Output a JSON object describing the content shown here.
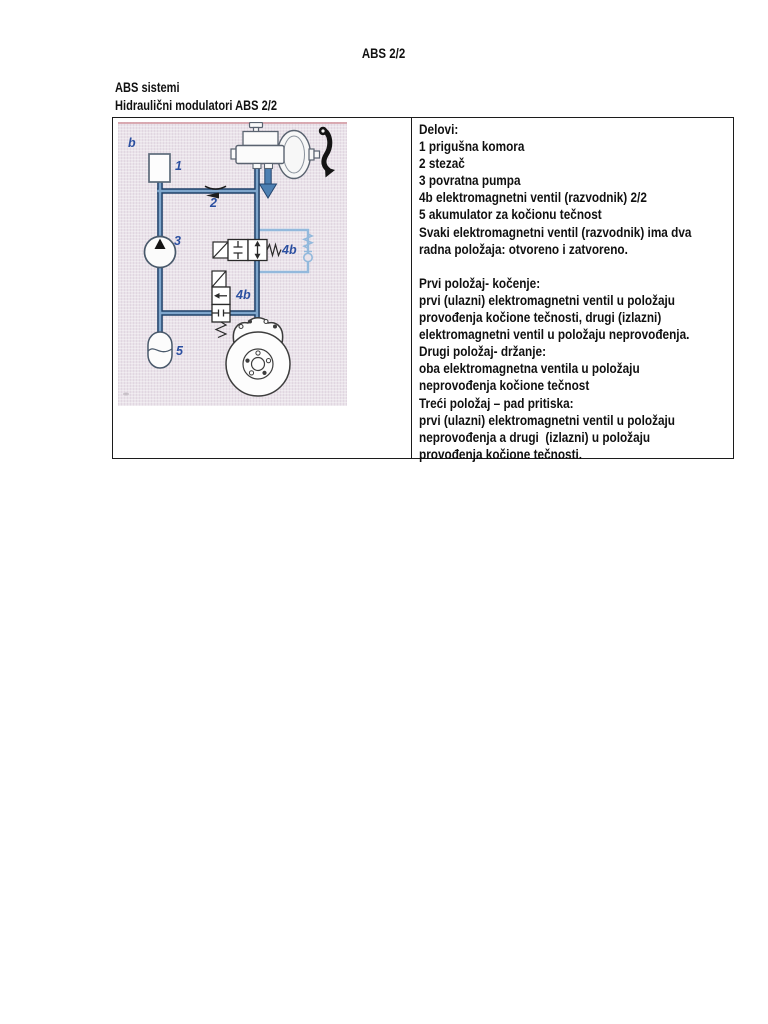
{
  "page_title": "ABS 2/2",
  "headings": {
    "line1": "ABS sistemi",
    "line2": "Hidraulični modulatori ABS 2/2"
  },
  "diagram": {
    "labels": {
      "b": "b",
      "n1": "1",
      "n2": "2",
      "n3": "3",
      "v4b_upper": "4b",
      "v4b_lower": "4b",
      "n5": "5"
    },
    "colors": {
      "scan_background": "#eae3ea",
      "scan_edge_pink": "#d49aa2",
      "pipe_dark": "#1f4068",
      "pipe_light": "#7fa6cc",
      "bypass_blue": "#93b9dc",
      "label_blue": "#2b4fa0"
    }
  },
  "info_panel": {
    "lines": [
      "Delovi:",
      "1 prigušna komora",
      "2 stezač",
      "3 povratna pumpa",
      "4b elektromagnetni ventil (razvodnik) 2/2",
      "5 akumulator za kočionu tečnost",
      "Svaki elektromagnetni ventil (razvodnik) ima dva",
      "radna položaja: otvoreno i zatvoreno.",
      "",
      "Prvi položaj- kočenje:",
      "prvi (ulazni) elektromagnetni ventil u položaju",
      "provođenja kočione tečnosti, drugi (izlazni)",
      "elektromagnetni ventil u položaju neprovođenja.",
      "Drugi položaj- držanje:",
      "oba elektromagnetna ventila u položaju",
      "neprovođenja kočione tečnost",
      "Treći položaj – pad pritiska:",
      "prvi (ulazni) elektromagnetni ventil u položaju",
      "neprovođenja a drugi  (izlazni) u položaju",
      "provođenja kočione tečnosti."
    ]
  }
}
